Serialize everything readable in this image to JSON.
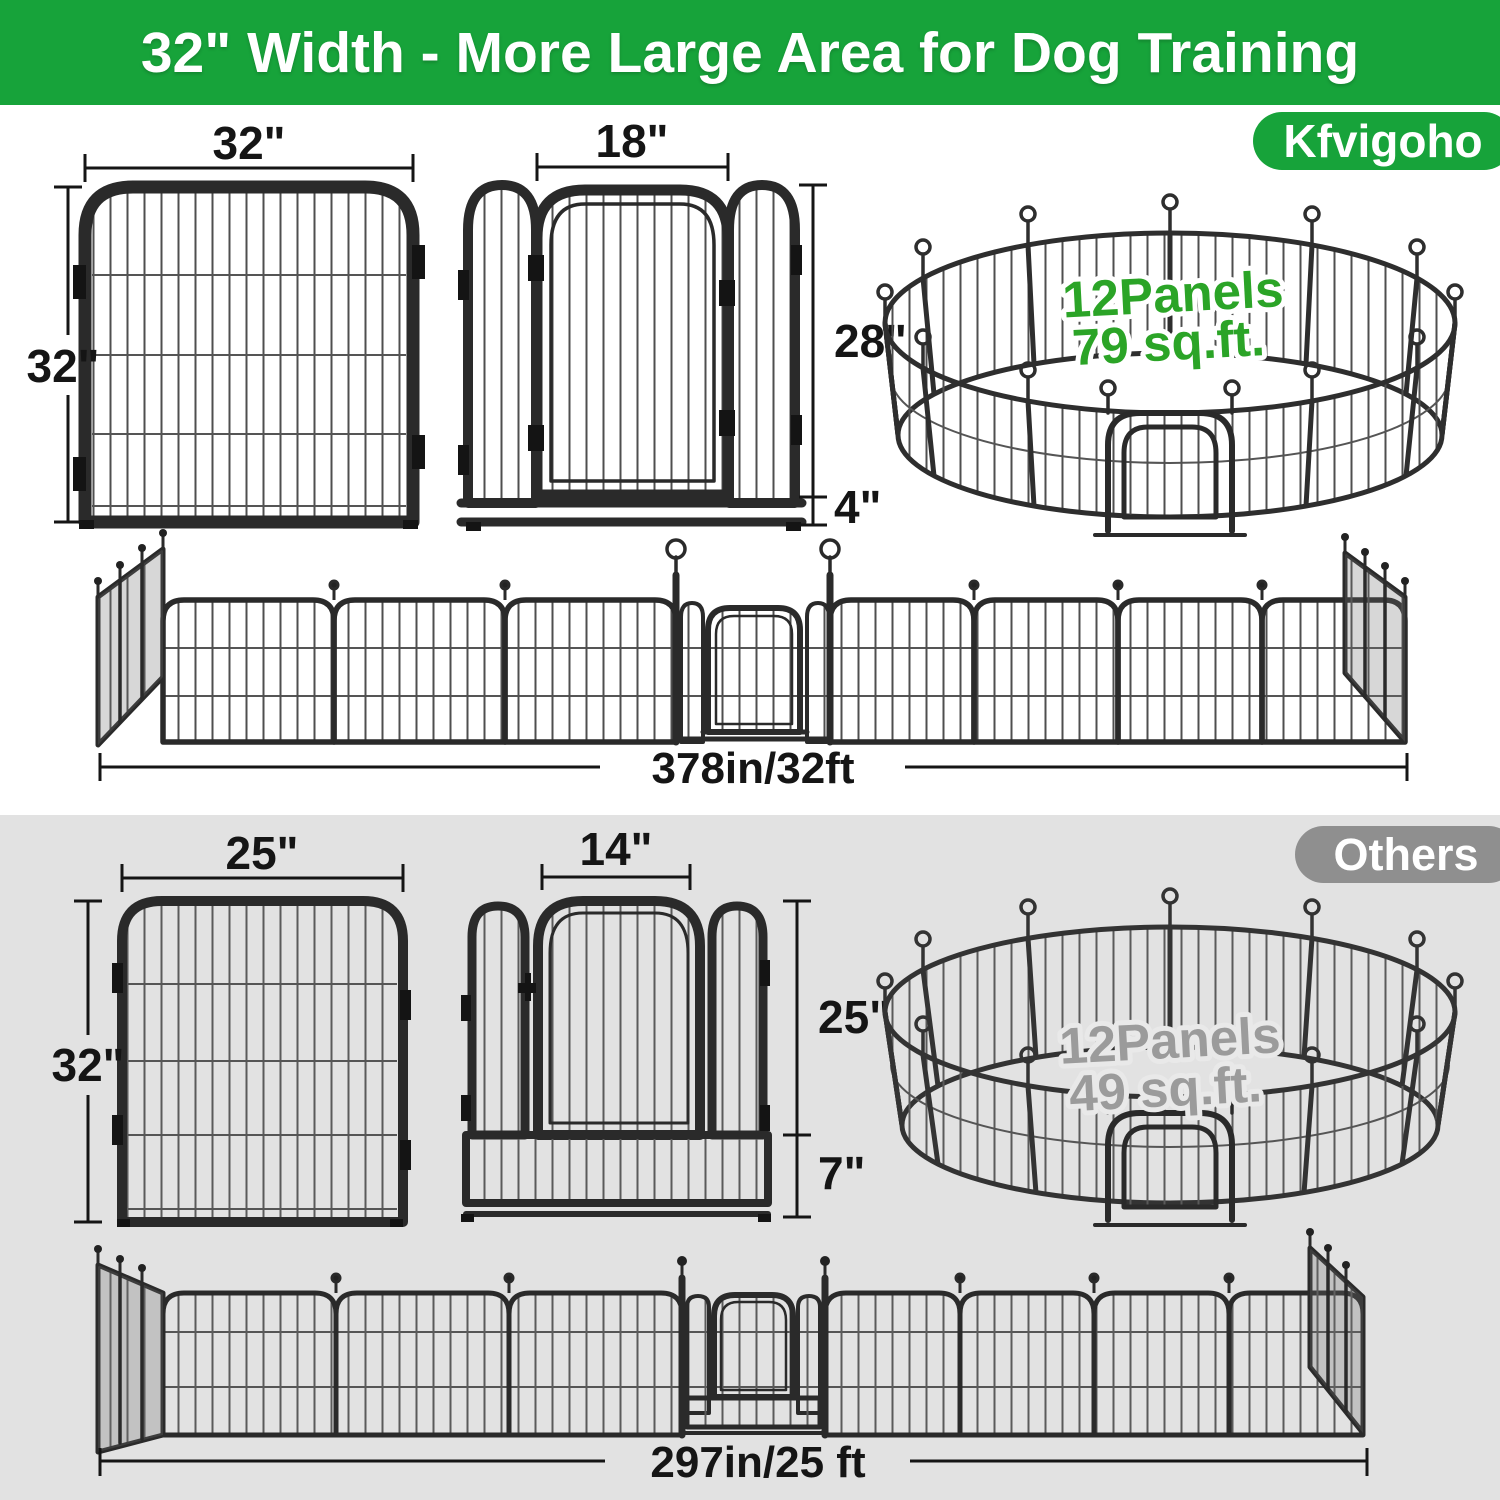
{
  "header": {
    "title": "32\" Width - More Large Area for Dog Training",
    "brand": "Kfvigoho"
  },
  "ours": {
    "panel": {
      "width": "32\"",
      "height": "32\""
    },
    "door_panel": {
      "width": "18\"",
      "height": "28\"",
      "bottom": "4\""
    },
    "pen": {
      "panels": "12Panels",
      "area": "79 sq.ft."
    },
    "fence": {
      "length": "378in/32ft"
    }
  },
  "others": {
    "badge": "Others",
    "panel": {
      "width": "25\"",
      "height": "32\""
    },
    "door_panel": {
      "width": "14\"",
      "height": "25\"",
      "bottom": "7\""
    },
    "pen": {
      "panels": "12Panels",
      "area": "49 sq.ft."
    },
    "fence": {
      "length": "297in/25 ft"
    }
  },
  "colors": {
    "banner_green": "#17a33a",
    "pen_text_green": "#2ba427",
    "section_gray": "#e2e2e2",
    "badge_gray": "#8f8f8f",
    "pen_text_gray": "#9b9b9b",
    "frame_dark": "#2a2a2a"
  }
}
